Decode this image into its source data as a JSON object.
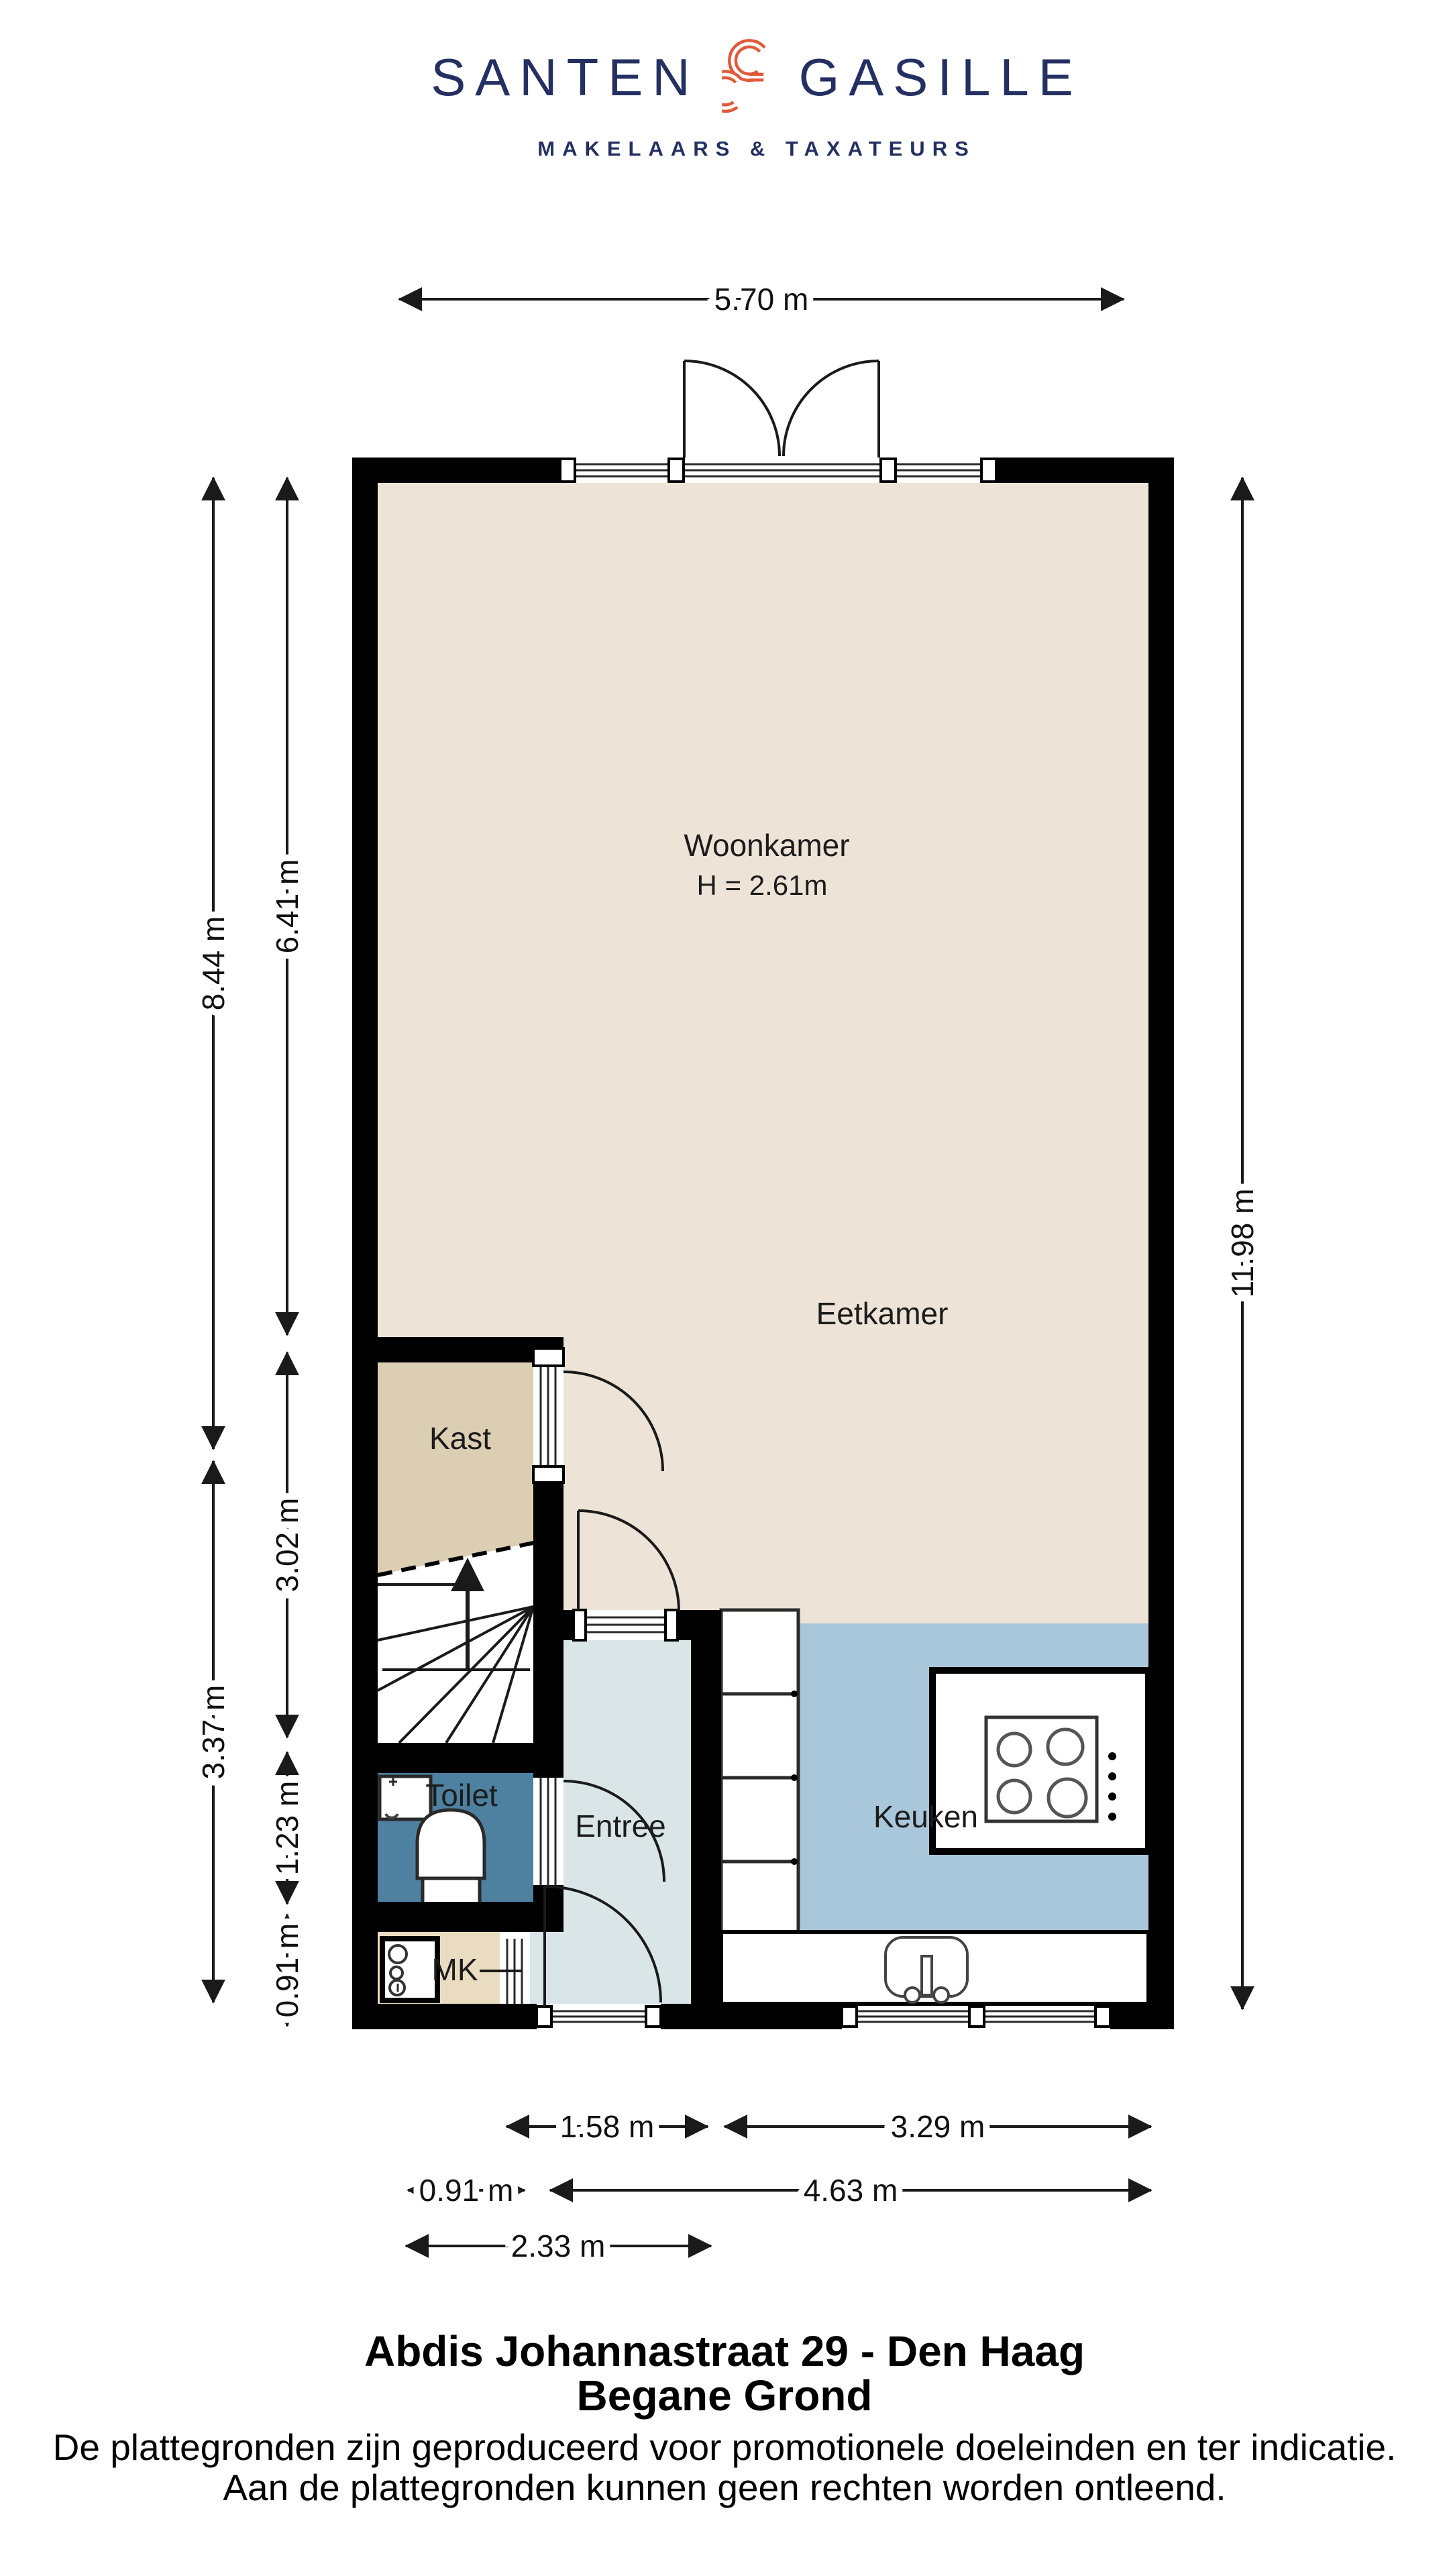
{
  "logo": {
    "brand_left": "SANTEN",
    "brand_right": "GASILLE",
    "tagline": "MAKELAARS & TAXATEURS"
  },
  "rooms": {
    "woonkamer": {
      "name": "Woonkamer",
      "height": "H = 2.61m"
    },
    "eetkamer": {
      "name": "Eetkamer"
    },
    "kast": {
      "name": "Kast"
    },
    "toilet": {
      "name": "Toilet"
    },
    "entree": {
      "name": "Entree"
    },
    "mk": {
      "name": "MK"
    },
    "keuken": {
      "name": "Keuken"
    }
  },
  "dims": {
    "top_width": "5.70 m",
    "left_outer_top": "8.44 m",
    "left_outer_bottom": "3.37 m",
    "left_inner_1": "6.41 m",
    "left_inner_2": "3.02 m",
    "left_inner_3": "1.23 m",
    "left_inner_4": "0.91 m",
    "right_height": "11.98 m",
    "bottom_entree": "1.58 m",
    "bottom_keuken": "3.29 m",
    "bottom_mk": "0.91 m",
    "bottom_right": "4.63 m",
    "bottom_left": "2.33 m"
  },
  "footer": {
    "address": "Abdis Johannastraat 29 - Den Haag",
    "floor": "Begane Grond",
    "disclaimer1": "De plattegronden zijn geproduceerd voor promotionele doeleinden en ter indicatie.",
    "disclaimer2": "Aan de plattegronden kunnen geen rechten worden ontleend."
  },
  "colors": {
    "navy": "#243061",
    "orange": "#E05A3A",
    "woonkamer": "#EDE4D7",
    "kast": "#DBCEB2",
    "entree": "#D9E5E6",
    "toilet": "#4E80A0",
    "keuken": "#A9C7DA",
    "mk": "#EADCC0",
    "wall": "#000000"
  }
}
